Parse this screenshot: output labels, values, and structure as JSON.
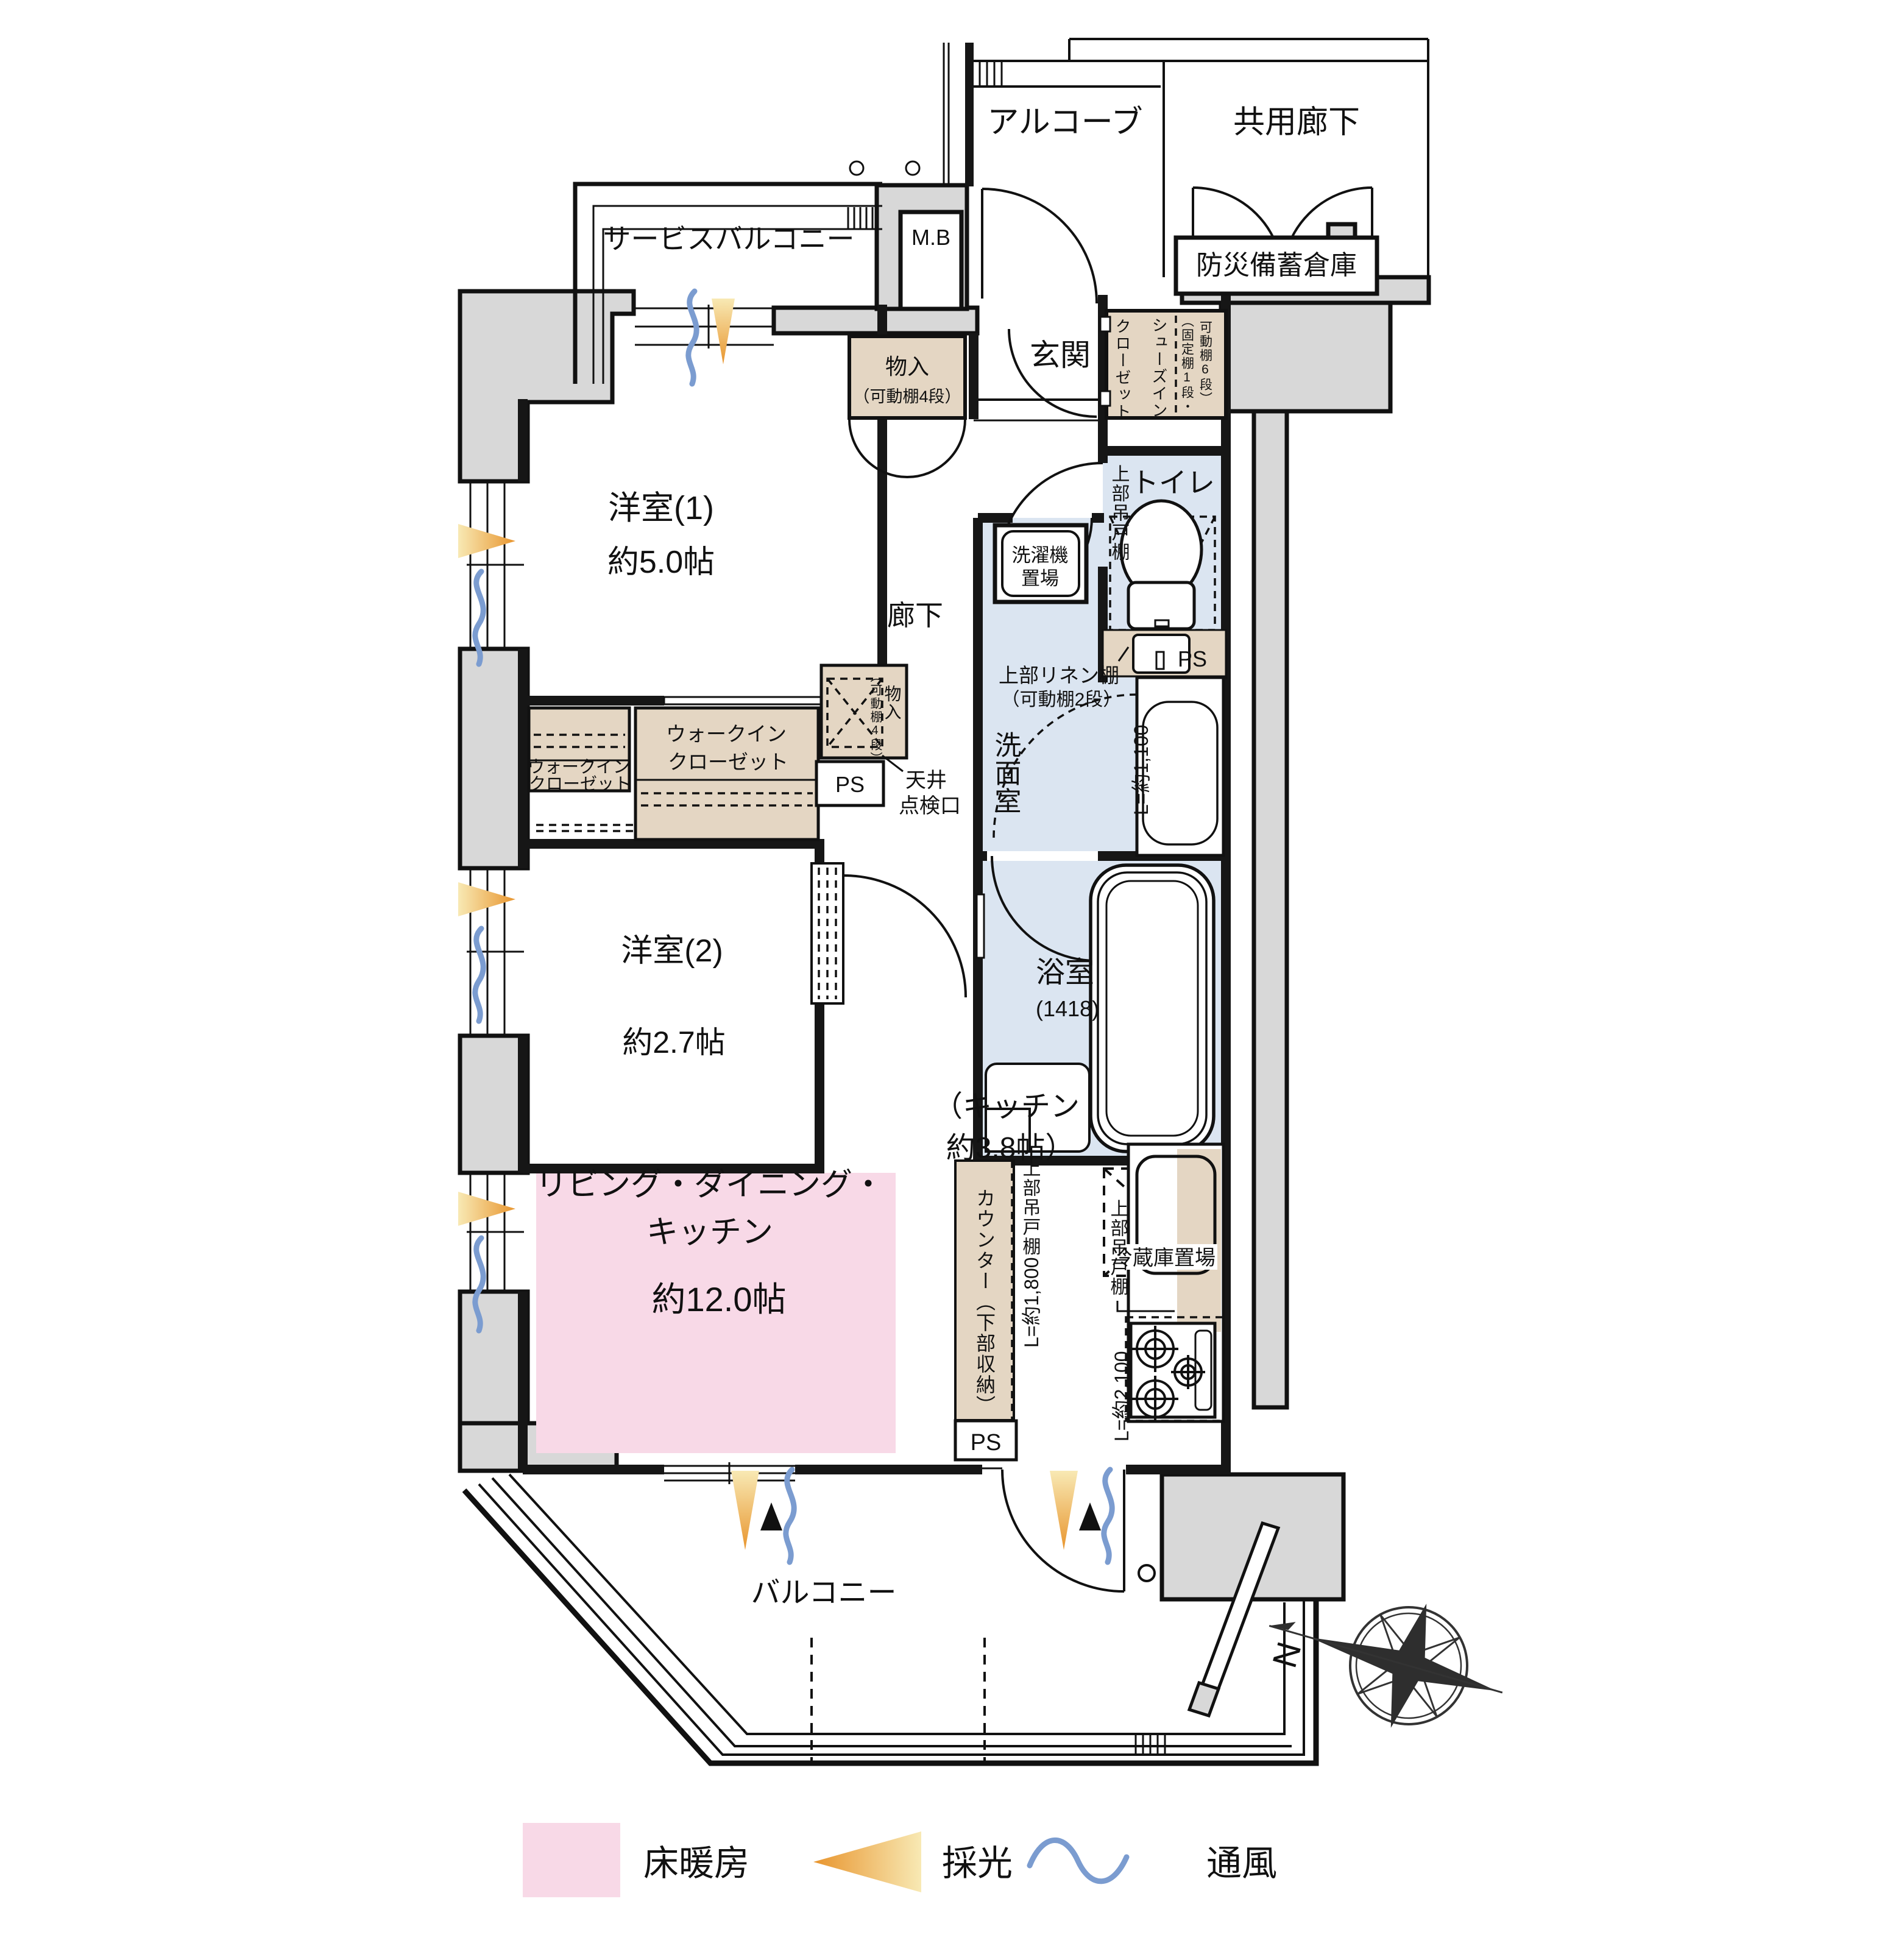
{
  "labels": {
    "alcove": "アルコーブ",
    "common_corridor": "共用廊下",
    "service_balcony": "サービスバルコニー",
    "mb": "M.B",
    "disaster_storage": "防災備蓄倉庫",
    "genkan": "玄関",
    "closet": "クローゼット",
    "shoes_in": "シューズイン",
    "shoes_shelf_1": "（固定棚1段・",
    "shoes_shelf_2": "可動棚6段）",
    "storage": "物入",
    "storage_shelf_4": "（可動棚4段）",
    "west_room_1": "洋室(1)",
    "west_room_1_size": "約5.0帖",
    "corridor": "廊下",
    "toilet": "トイレ",
    "upper_hanging_cabinet": "上部吊戸棚",
    "ps": "PS",
    "washer_1": "洗濯機",
    "washer_2": "置場",
    "linen_1": "上部リネン棚",
    "linen_2": "（可動棚2段）",
    "washroom": "洗面室",
    "l_1100": "L=約1,100",
    "walk_in": "ウォークイン",
    "west_room_2": "洋室(2)",
    "west_room_2_size": "約2.7帖",
    "ceiling_1": "天井",
    "ceiling_2": "点検口",
    "bath": "浴室",
    "bath_size": "(1418)",
    "fridge": "冷蔵庫置場",
    "kitchen_1": "（キッチン",
    "kitchen_2": "約3.8帖）",
    "counter": "カウンター（下部収納）",
    "l_1800": "L=約1,800",
    "l_2100": "L=約2,100",
    "ldk_1": "リビング・ダイニング・",
    "ldk_2": "キッチン",
    "ldk_3": "約12.0帖",
    "balcony": "バルコニー"
  },
  "legend": {
    "floor_heating": "床暖房",
    "daylight": "採光",
    "ventilation": "通風"
  },
  "compass": {
    "north": "N"
  },
  "colors": {
    "floor_heating": "#f8d9e7",
    "wet_area": "#dbe5f1",
    "storage_fill": "#e4d6c3",
    "wall_gray": "#d8d8d8",
    "daylight_dark": "#e8952e",
    "daylight_light": "#f8e9b4",
    "ventilation": "#7b9cd0"
  }
}
